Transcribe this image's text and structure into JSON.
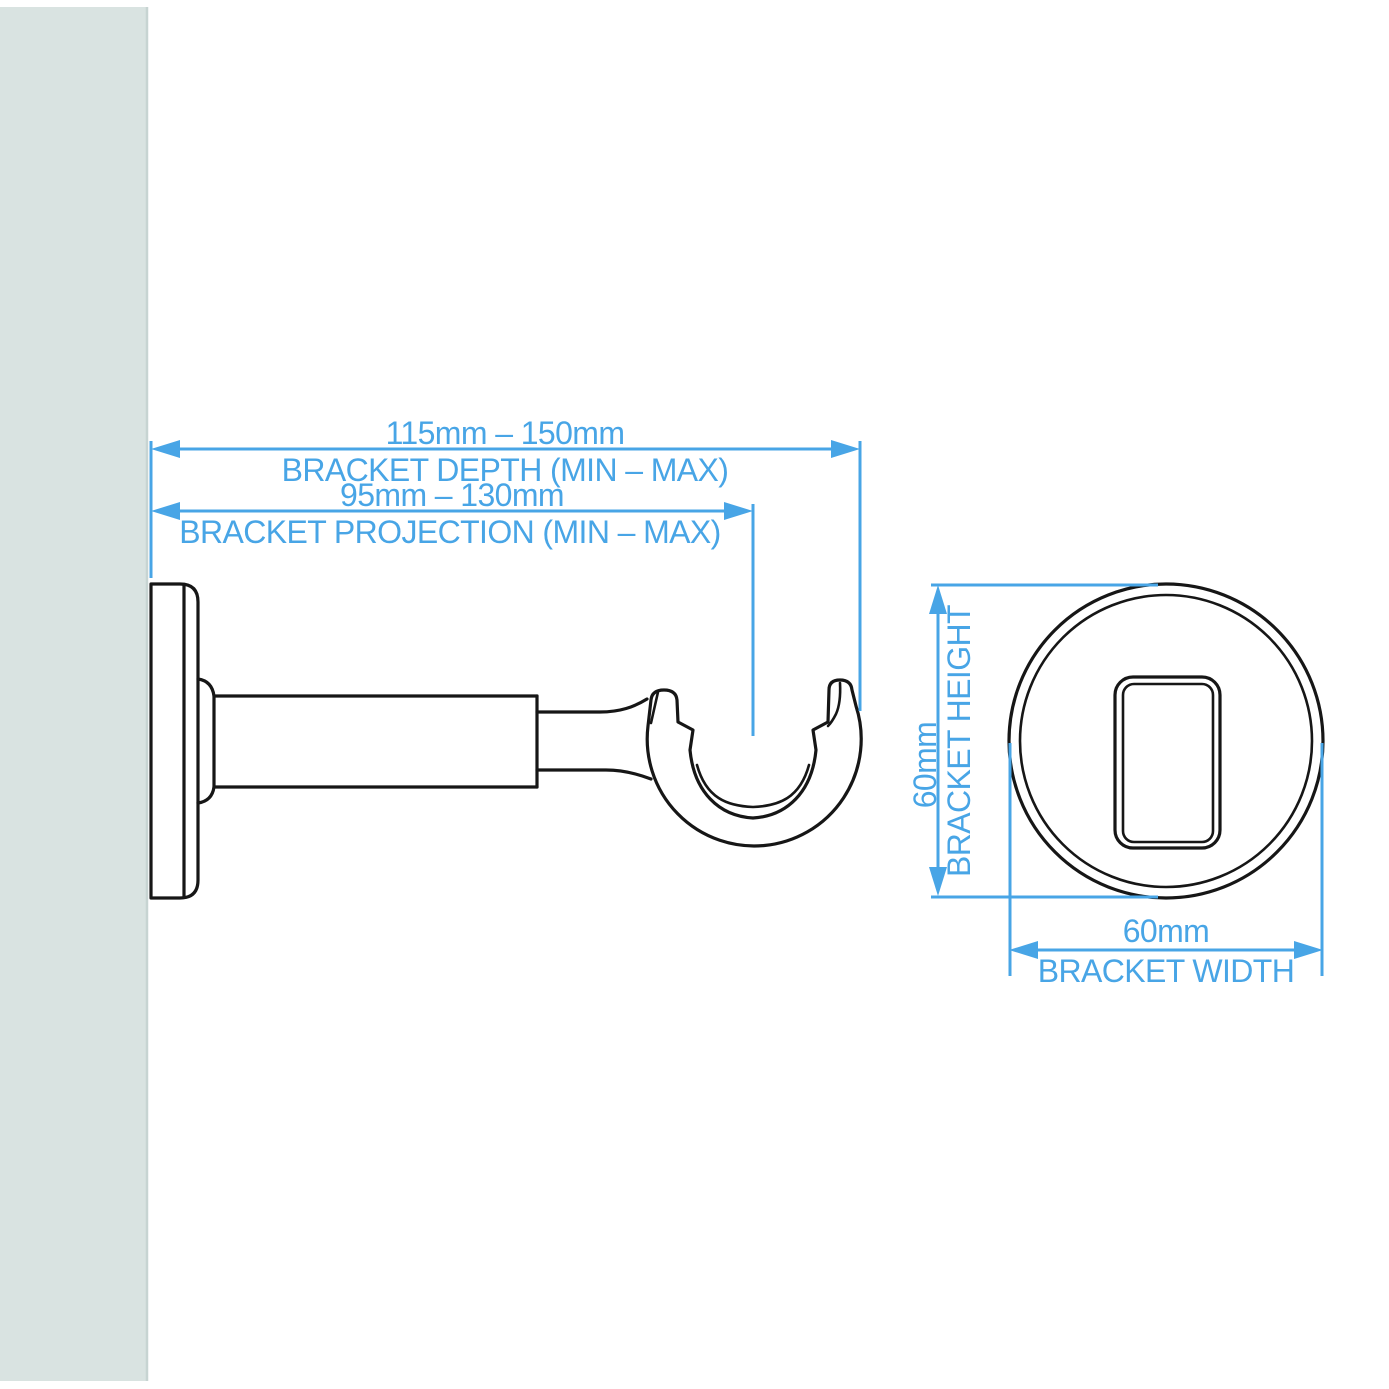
{
  "colors": {
    "dimension_blue": "#48A5E6",
    "outline_black": "#161616",
    "wall_fill": "#D9E3E1"
  },
  "side_view": {
    "depth_value": "115mm – 150mm",
    "depth_label": "BRACKET DEPTH (MIN – MAX)",
    "projection_value": "95mm – 130mm",
    "projection_label": "BRACKET PROJECTION (MIN – MAX)"
  },
  "front_view": {
    "height_value": "60mm",
    "height_label": "BRACKET HEIGHT",
    "width_value": "60mm",
    "width_label": "BRACKET WIDTH"
  }
}
